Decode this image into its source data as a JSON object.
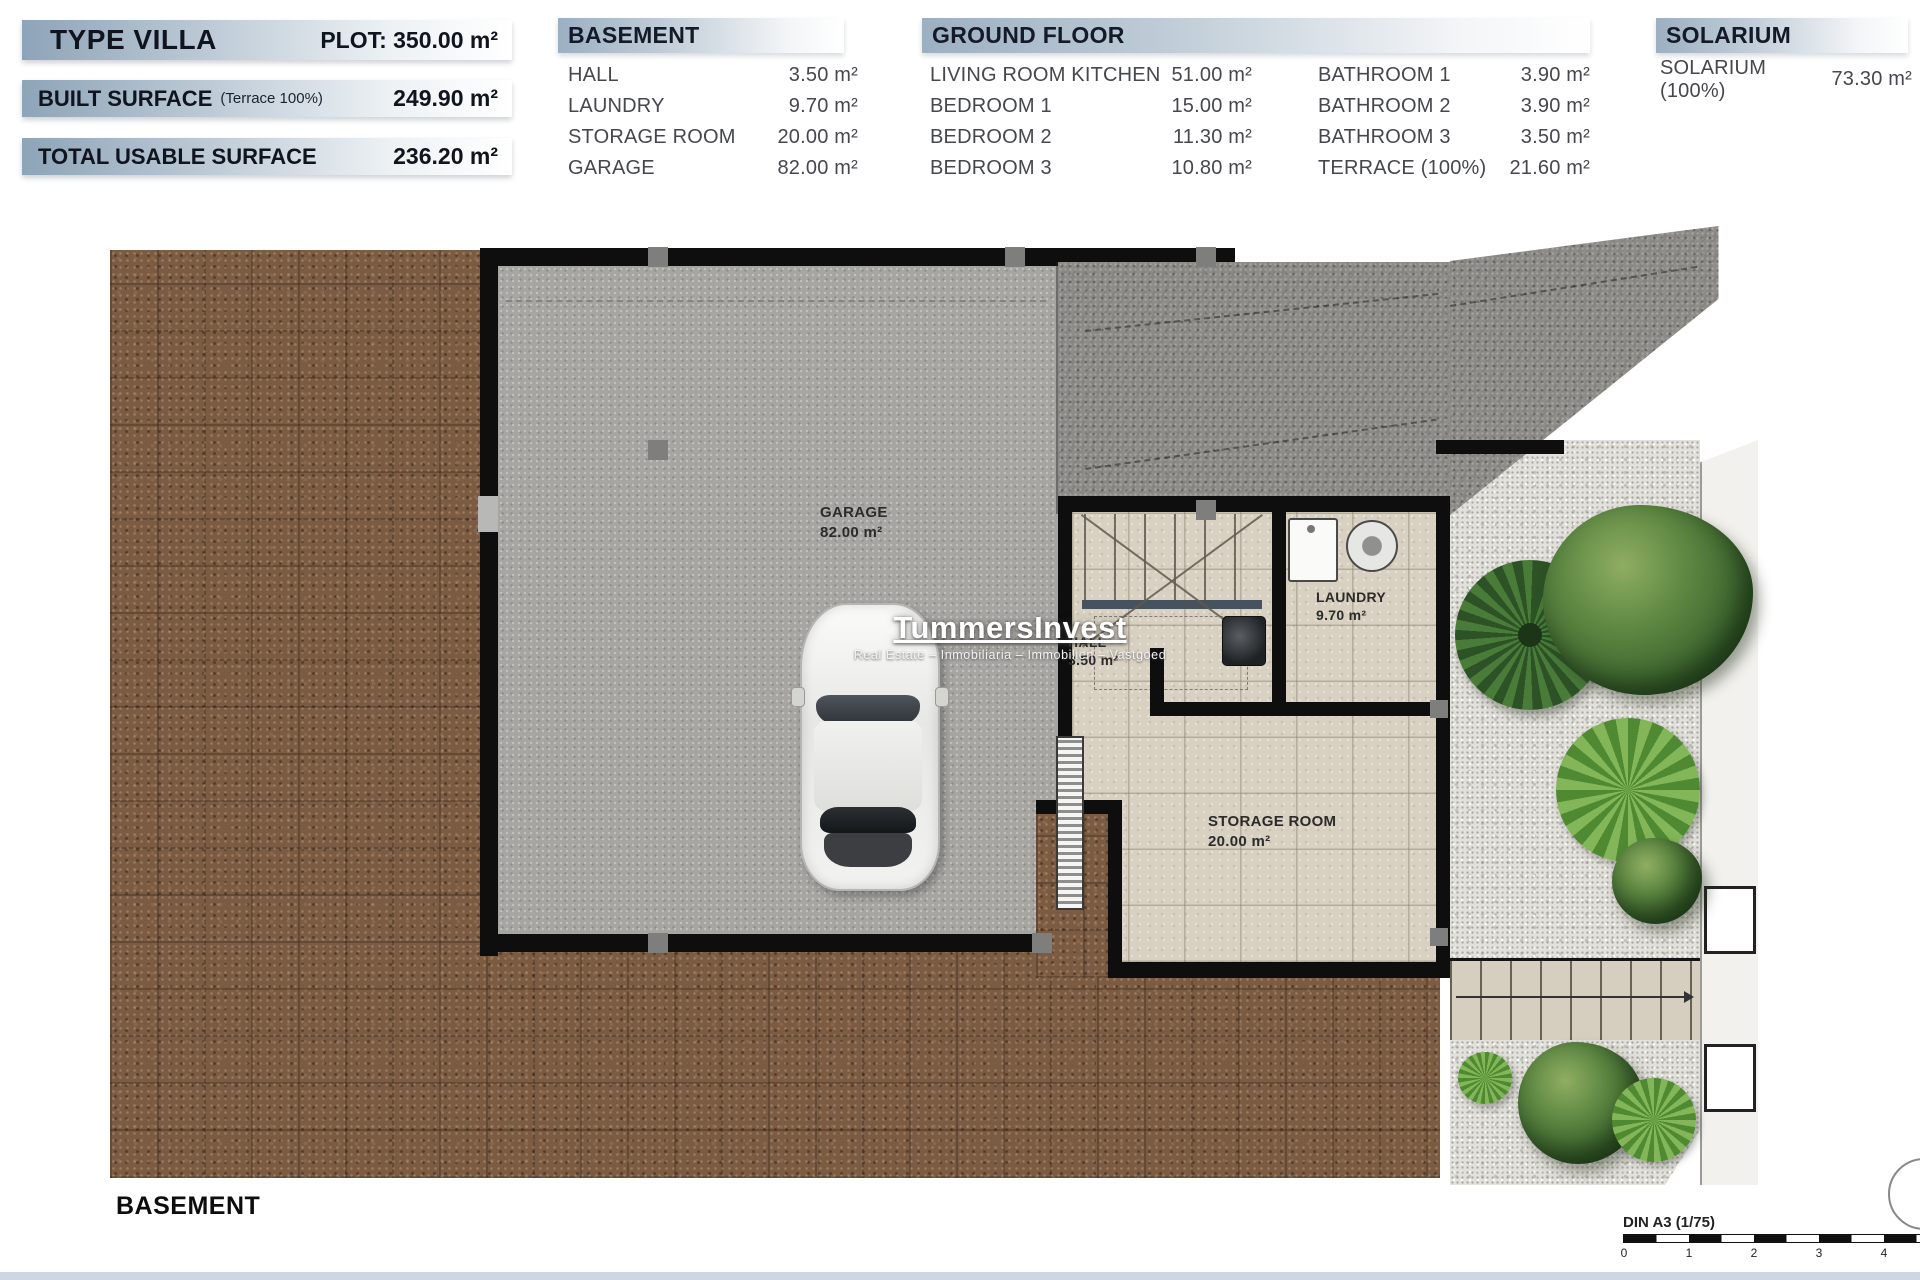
{
  "summary": {
    "plot": {
      "title": "TYPE VILLA",
      "value": "PLOT: 350.00 m²"
    },
    "built": {
      "title": "BUILT SURFACE",
      "note": "(Terrace 100%)",
      "value": "249.90 m²"
    },
    "usable": {
      "title": "TOTAL USABLE SURFACE",
      "value": "236.20 m²"
    }
  },
  "tables": {
    "basement": {
      "title": "BASEMENT",
      "rows": [
        {
          "label": "HALL",
          "value": "3.50 m²"
        },
        {
          "label": "LAUNDRY",
          "value": "9.70 m²"
        },
        {
          "label": "STORAGE ROOM",
          "value": "20.00 m²"
        },
        {
          "label": "GARAGE",
          "value": "82.00 m²"
        }
      ]
    },
    "ground_floor": {
      "title": "GROUND FLOOR",
      "col1": [
        {
          "label": "LIVING ROOM KITCHEN",
          "value": "51.00 m²"
        },
        {
          "label": "BEDROOM 1",
          "value": "15.00 m²"
        },
        {
          "label": "BEDROOM 2",
          "value": "11.30 m²"
        },
        {
          "label": "BEDROOM 3",
          "value": "10.80 m²"
        }
      ],
      "col2": [
        {
          "label": "BATHROOM 1",
          "value": "3.90 m²"
        },
        {
          "label": "BATHROOM 2",
          "value": "3.90 m²"
        },
        {
          "label": "BATHROOM 3",
          "value": "3.50 m²"
        },
        {
          "label": "TERRACE (100%)",
          "value": "21.60 m²"
        }
      ]
    },
    "solarium": {
      "title": "SOLARIUM",
      "rows": [
        {
          "label": "SOLARIUM (100%)",
          "value": "73.30 m²"
        }
      ]
    }
  },
  "plan": {
    "rooms": {
      "garage": {
        "name": "GARAGE",
        "area": "82.00 m²"
      },
      "hall": {
        "name": "HALL",
        "area": "3.50 m²"
      },
      "laundry": {
        "name": "LAUNDRY",
        "area": "9.70 m²"
      },
      "storage": {
        "name": "STORAGE ROOM",
        "area": "20.00 m²"
      }
    }
  },
  "watermark": {
    "brand": "TummersInvest",
    "tagline": "Real Estate – Inmobiliaria – Immobilien – Vastgoed"
  },
  "footer": {
    "floor_title": "BASEMENT",
    "scale_label": "DIN A3 (1/75)",
    "scale_ticks": [
      "0",
      "1",
      "2",
      "3",
      "4"
    ]
  },
  "colors": {
    "header_gradient_start": "#8EA4B8",
    "text_dark": "#151926",
    "table_text": "#45474D",
    "dirt": "#7B5B42",
    "concrete": "#A7A5A1",
    "driveway": "#8E8C88",
    "tile": "#D8D1C2",
    "gravel": "#E3E1DC",
    "wall": "#0E0E0E"
  }
}
